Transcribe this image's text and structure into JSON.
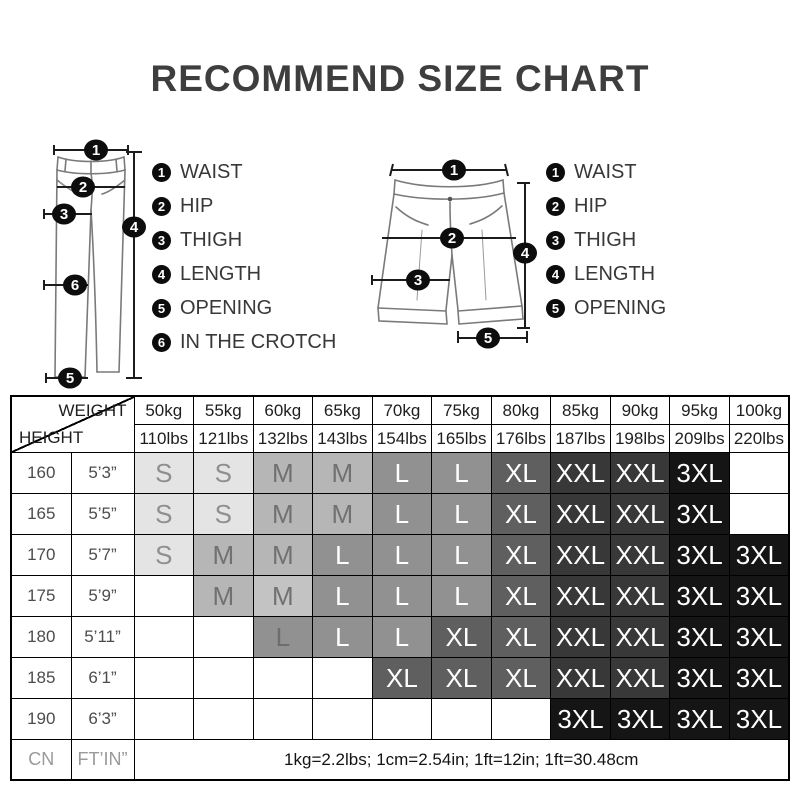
{
  "title": "RECOMMEND SIZE CHART",
  "pants_legend": [
    {
      "num": "1",
      "label": "WAIST"
    },
    {
      "num": "2",
      "label": "HIP"
    },
    {
      "num": "3",
      "label": "THIGH"
    },
    {
      "num": "4",
      "label": "LENGTH"
    },
    {
      "num": "5",
      "label": "OPENING"
    },
    {
      "num": "6",
      "label": "IN THE CROTCH"
    }
  ],
  "shorts_legend": [
    {
      "num": "1",
      "label": "WAIST"
    },
    {
      "num": "2",
      "label": "HIP"
    },
    {
      "num": "3",
      "label": "THIGH"
    },
    {
      "num": "4",
      "label": "LENGTH"
    },
    {
      "num": "5",
      "label": "OPENING"
    }
  ],
  "table": {
    "corner": {
      "weight_label": "WEIGHT",
      "height_label": "HEIGHT"
    },
    "weight_kg": [
      "50kg",
      "55kg",
      "60kg",
      "65kg",
      "70kg",
      "75kg",
      "80kg",
      "85kg",
      "90kg",
      "95kg",
      "100kg"
    ],
    "weight_lbs": [
      "110lbs",
      "121lbs",
      "132lbs",
      "143lbs",
      "154lbs",
      "165lbs",
      "176lbs",
      "187lbs",
      "198lbs",
      "209lbs",
      "220lbs"
    ],
    "rows": [
      {
        "height_cm": "160",
        "height_ft": "5’3”",
        "sizes": [
          "S",
          "S",
          "M",
          "M",
          "L",
          "L",
          "XL",
          "XXL",
          "XXL",
          "3XL",
          ""
        ]
      },
      {
        "height_cm": "165",
        "height_ft": "5’5”",
        "sizes": [
          "S",
          "S",
          "M",
          "M",
          "L",
          "L",
          "XL",
          "XXL",
          "XXL",
          "3XL",
          ""
        ]
      },
      {
        "height_cm": "170",
        "height_ft": "5’7”",
        "sizes": [
          "S",
          "M",
          "M",
          "L",
          "L",
          "L",
          "XL",
          "XXL",
          "XXL",
          "3XL",
          "3XL"
        ]
      },
      {
        "height_cm": "175",
        "height_ft": "5’9”",
        "sizes": [
          "",
          "M",
          "M",
          "L",
          "L",
          "L",
          "XL",
          "XXL",
          "XXL",
          "3XL",
          "3XL"
        ]
      },
      {
        "height_cm": "180",
        "height_ft": "5’11”",
        "sizes": [
          "",
          "",
          "L",
          "L",
          "L",
          "XL",
          "XL",
          "XXL",
          "XXL",
          "3XL",
          "3XL"
        ]
      },
      {
        "height_cm": "185",
        "height_ft": "6’1”",
        "sizes": [
          "",
          "",
          "",
          "",
          "XL",
          "XL",
          "XL",
          "XXL",
          "XXL",
          "3XL",
          "3XL"
        ]
      },
      {
        "height_cm": "190",
        "height_ft": "6’3”",
        "sizes": [
          "",
          "",
          "",
          "",
          "",
          "",
          "",
          "3XL",
          "3XL",
          "3XL",
          "3XL"
        ]
      }
    ],
    "footer": {
      "unit_left": "CN",
      "unit_right": "FT’IN”",
      "note": "1kg=2.2lbs; 1cm=2.54in; 1ft=12in; 1ft=30.48cm"
    }
  },
  "size_styles": {
    "S": {
      "bg": "#e4e4e4",
      "fg": "#8f8f8f"
    },
    "M": {
      "bg": "#b6b6b6",
      "fg": "#717171"
    },
    "L": {
      "bg": "#919191",
      "fg": "#ffffff"
    },
    "XL": {
      "bg": "#5f5f5f",
      "fg": "#ffffff"
    },
    "XXL": {
      "bg": "#383838",
      "fg": "#ffffff"
    },
    "3XL": {
      "bg": "#151515",
      "fg": "#ffffff"
    },
    "": {
      "bg": "#ffffff",
      "fg": "#000000"
    }
  },
  "cell_overrides": [
    {
      "row": 3,
      "col": 2,
      "bg": "#c3c3c3"
    },
    {
      "row": 4,
      "col": 2,
      "fg": "#6d6d6d"
    }
  ]
}
